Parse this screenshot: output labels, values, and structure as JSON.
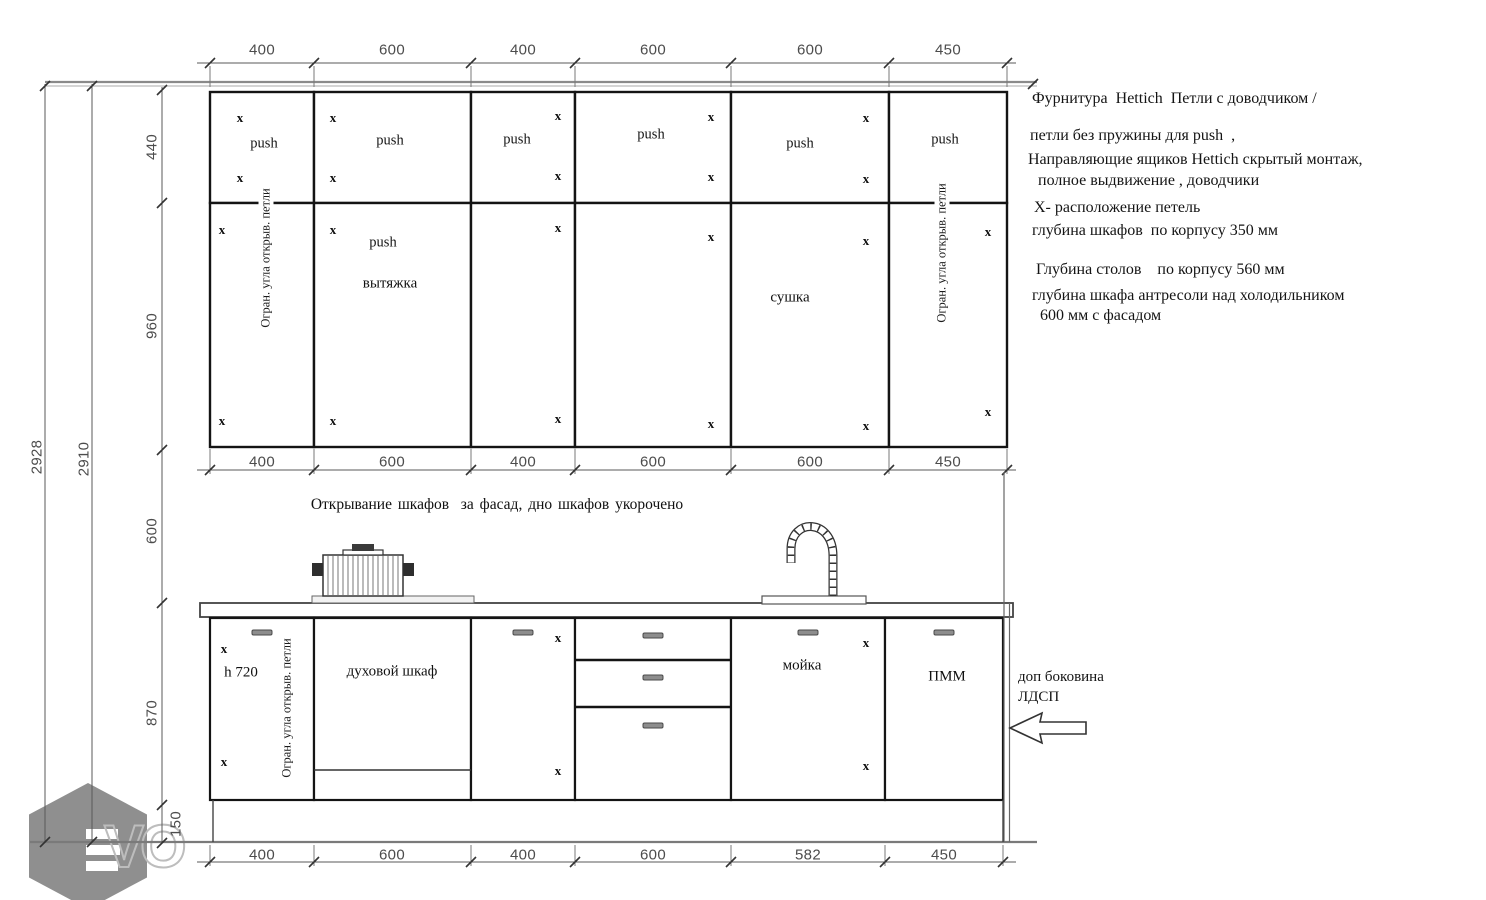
{
  "dims": {
    "top": [
      "400",
      "600",
      "400",
      "600",
      "600",
      "450"
    ],
    "mid": [
      "400",
      "600",
      "400",
      "600",
      "600",
      "450"
    ],
    "bottom": [
      "400",
      "600",
      "400",
      "600",
      "582",
      "450"
    ],
    "total": [
      "2928",
      "2910"
    ],
    "sections": [
      "440",
      "960",
      "600",
      "870",
      "150"
    ]
  },
  "cabinets": {
    "push": "push",
    "x": "x",
    "hinge_limiter": "Огран. угла открыв. петли",
    "hood": "вытяжка",
    "dryer": "сушка",
    "oven": "духовой шкаф",
    "sink": "мойка",
    "dishwasher": "ПММ",
    "base_height": "h 720"
  },
  "notes": {
    "opening": "Открывание шкафов  за фасад, дно шкафов укорочено",
    "side_panel_line1": "доп боковина",
    "side_panel_line2": "ЛДСП",
    "right": [
      "Фурнитура  Hettich  Петли с доводчиком /",
      "петли без пружины для push  ,",
      "Направляющие ящиков Hettich скрытый монтаж,",
      "полное выдвижение , доводчики",
      "Х- расположение петель",
      "глубина шкафов  по корпусу 350 мм",
      "Глубина столов    по корпусу 560 мм",
      "глубина шкафа антресоли над холодильником",
      "600 мм с фасадом"
    ]
  },
  "logo": {
    "vo": "VO"
  },
  "colors": {
    "cabinet_line": "#141414",
    "dim_line": "#5a5a5a",
    "logo_gray": "#8f8f8f"
  }
}
